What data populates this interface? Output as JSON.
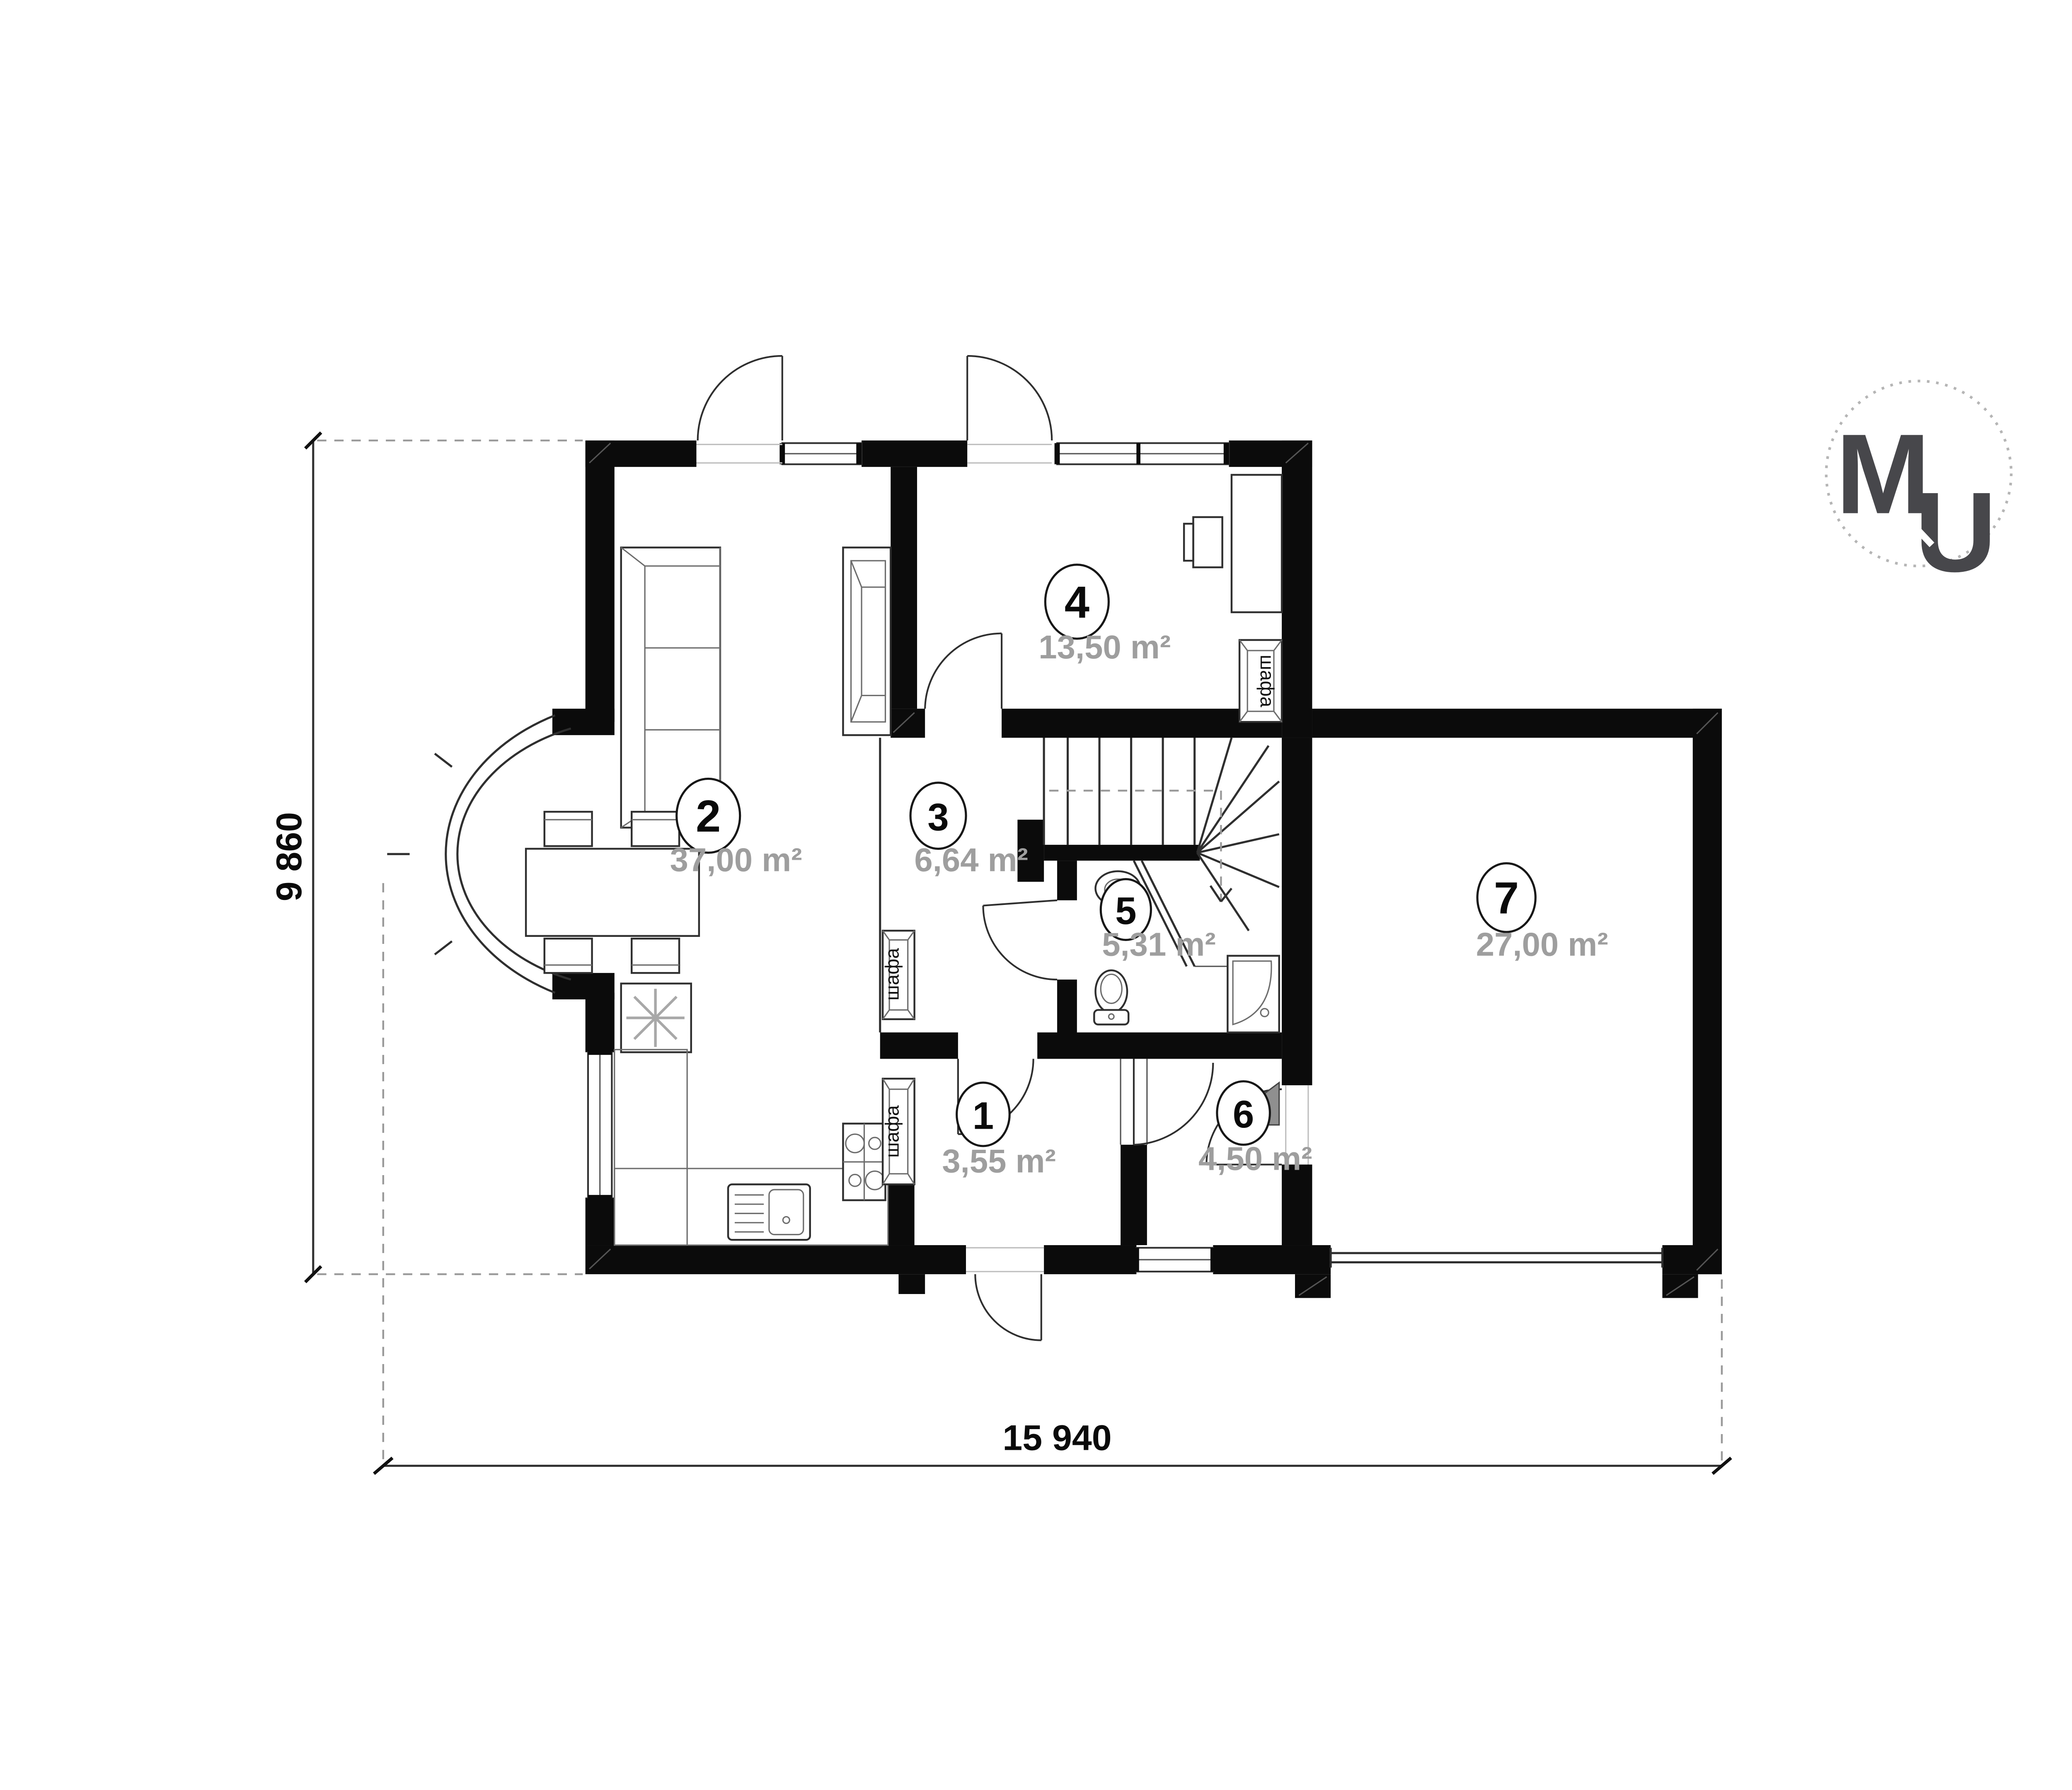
{
  "rooms": [
    {
      "number": "1",
      "area": "3,55 m²"
    },
    {
      "number": "2",
      "area": "37,00 m²"
    },
    {
      "number": "3",
      "area": "6,64 m²"
    },
    {
      "number": "4",
      "area": "13,50 m²"
    },
    {
      "number": "5",
      "area": "5,31 m²"
    },
    {
      "number": "6",
      "area": "4,50 m²"
    },
    {
      "number": "7",
      "area": "27,00 m²"
    }
  ],
  "labels": {
    "wardrobe": "шафа"
  },
  "dimensions": {
    "total_width": "15 940",
    "total_height": "9 860"
  },
  "logo": {
    "m": "M",
    "u": "U"
  },
  "colors": {
    "wall": "#0b0b0b",
    "area_text": "#9e9e9e",
    "logo": "#47474b",
    "chimney_gray": "#8f8f8f"
  }
}
